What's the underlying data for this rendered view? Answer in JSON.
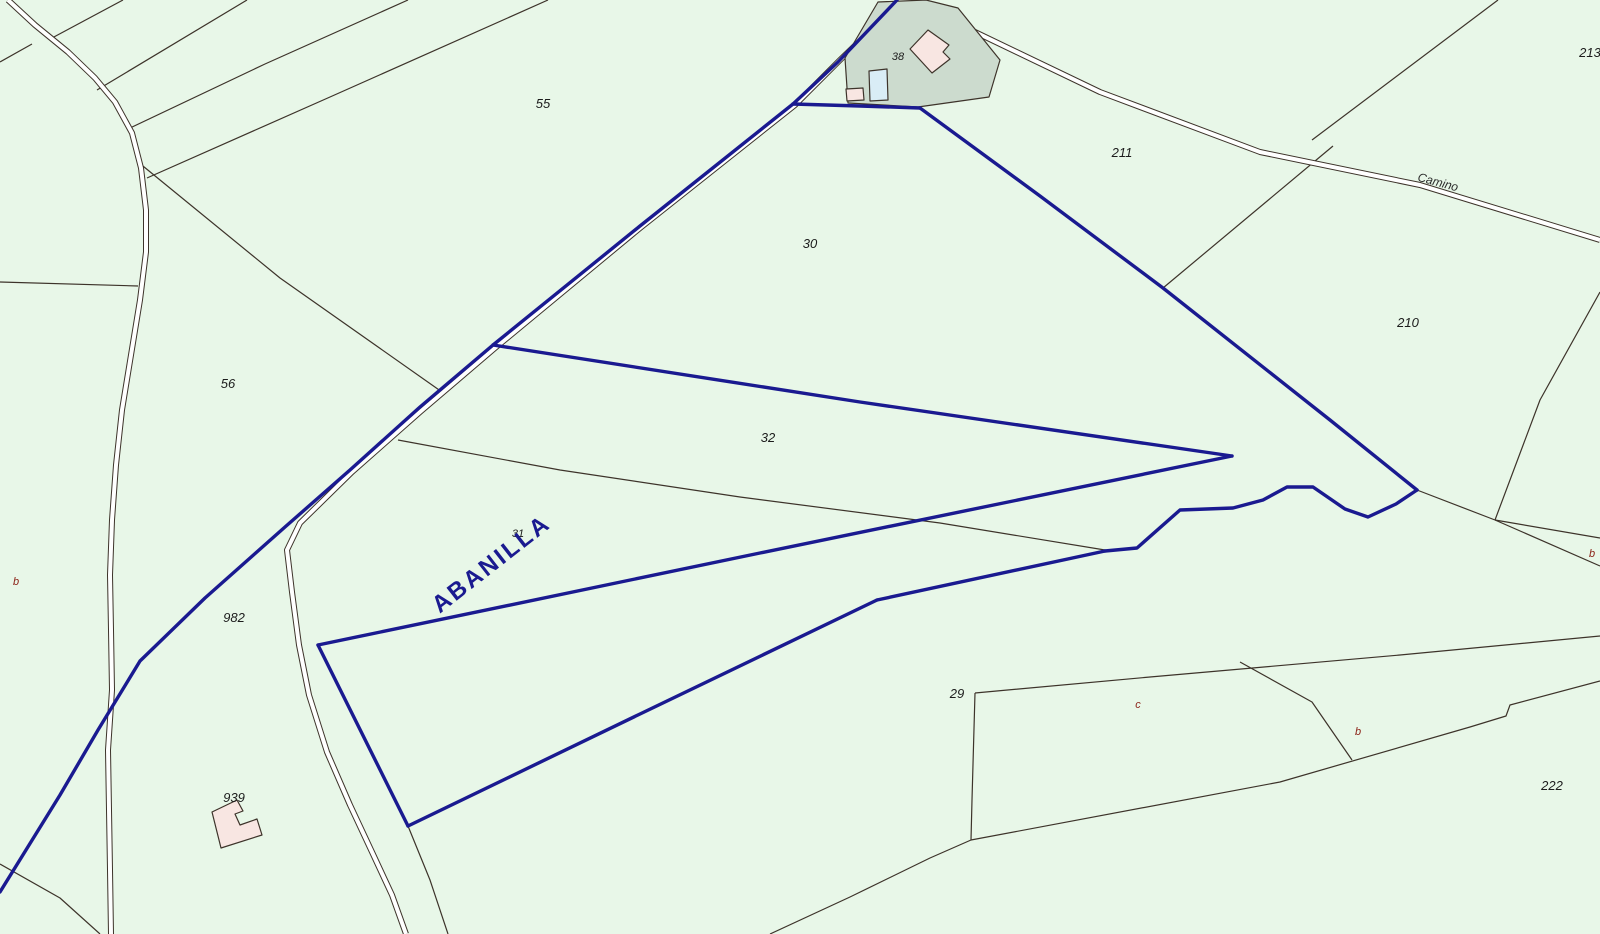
{
  "map": {
    "title": "cadastral-parcel-map",
    "colors": {
      "background": "#e8f7e8",
      "parcel_line": "#3d332a",
      "boundary": "#1a1a90",
      "road_fill": "#ffffff",
      "parcel38_fill": "#ccdbce",
      "building_fill": "#f8e6e2",
      "annex_blue_fill": "#d9edf6",
      "label": "#1c1c1c",
      "sub_label": "#8c2318"
    },
    "labels": [
      {
        "name": "parcel-55",
        "text": "55",
        "x": 543,
        "y": 108,
        "size": 13
      },
      {
        "name": "parcel-38",
        "text": "38",
        "x": 898,
        "y": 60,
        "size": 11
      },
      {
        "name": "parcel-211",
        "text": "211",
        "x": 1122,
        "y": 157,
        "size": 13
      },
      {
        "name": "parcel-213",
        "text": "213",
        "x": 1590,
        "y": 57,
        "size": 13
      },
      {
        "name": "road-camino",
        "text": "Camino",
        "x": 1437,
        "y": 186,
        "size": 12,
        "rotate": 15,
        "color": "#2b2b2b"
      },
      {
        "name": "parcel-30",
        "text": "30",
        "x": 810,
        "y": 248,
        "size": 13
      },
      {
        "name": "parcel-210",
        "text": "210",
        "x": 1408,
        "y": 327,
        "size": 13
      },
      {
        "name": "parcel-56",
        "text": "56",
        "x": 228,
        "y": 388,
        "size": 13
      },
      {
        "name": "parcel-32",
        "text": "32",
        "x": 768,
        "y": 442,
        "size": 13
      },
      {
        "name": "parcel-31",
        "text": "31",
        "x": 518,
        "y": 537,
        "size": 11
      },
      {
        "name": "municipality-abanilla",
        "text": "ABANILLA",
        "x": 496,
        "y": 570,
        "size": 24,
        "rotate": -38,
        "color": "#1a1a90",
        "bold": true,
        "spacing": 2.5
      },
      {
        "name": "sub-parcel-b-left",
        "text": "b",
        "x": 16,
        "y": 585,
        "size": 11,
        "color": "#8c2318"
      },
      {
        "name": "parcel-982",
        "text": "982",
        "x": 234,
        "y": 622,
        "size": 13
      },
      {
        "name": "sub-parcel-b-right",
        "text": "b",
        "x": 1592,
        "y": 557,
        "size": 11,
        "color": "#8c2318"
      },
      {
        "name": "parcel-939",
        "text": "939",
        "x": 234,
        "y": 802,
        "size": 13
      },
      {
        "name": "parcel-29",
        "text": "29",
        "x": 957,
        "y": 698,
        "size": 13
      },
      {
        "name": "sub-parcel-c",
        "text": "c",
        "x": 1138,
        "y": 708,
        "size": 11,
        "color": "#8c2318"
      },
      {
        "name": "sub-parcel-b-bottom",
        "text": "b",
        "x": 1358,
        "y": 735,
        "size": 11,
        "color": "#8c2318"
      },
      {
        "name": "parcel-222",
        "text": "222",
        "x": 1552,
        "y": 790,
        "size": 13
      }
    ],
    "roads": [
      {
        "name": "road-left-vertical",
        "points": [
          [
            8,
            0
          ],
          [
            35,
            25
          ],
          [
            68,
            52
          ],
          [
            95,
            78
          ],
          [
            115,
            102
          ],
          [
            132,
            133
          ],
          [
            141,
            168
          ],
          [
            146,
            210
          ],
          [
            146,
            252
          ],
          [
            140,
            300
          ],
          [
            131,
            355
          ],
          [
            122,
            410
          ],
          [
            116,
            465
          ],
          [
            112,
            520
          ],
          [
            110,
            575
          ],
          [
            111,
            630
          ],
          [
            112,
            690
          ],
          [
            108,
            750
          ],
          [
            109,
            810
          ],
          [
            110,
            870
          ],
          [
            111,
            934
          ]
        ]
      },
      {
        "name": "road-main-diagonal",
        "points": [
          [
            900,
            2
          ],
          [
            840,
            60
          ],
          [
            795,
            105
          ],
          [
            640,
            228
          ],
          [
            495,
            348
          ],
          [
            420,
            412
          ],
          [
            352,
            472
          ],
          [
            300,
            523
          ],
          [
            287,
            550
          ],
          [
            292,
            592
          ],
          [
            299,
            645
          ],
          [
            309,
            695
          ],
          [
            327,
            752
          ],
          [
            350,
            805
          ],
          [
            372,
            852
          ],
          [
            392,
            895
          ],
          [
            406,
            934
          ]
        ]
      },
      {
        "name": "road-camino",
        "points": [
          [
            950,
            20
          ],
          [
            1100,
            92
          ],
          [
            1260,
            152
          ],
          [
            1420,
            185
          ],
          [
            1600,
            240
          ]
        ]
      }
    ],
    "parcel_lines": [
      {
        "points": [
          [
            123,
            0
          ],
          [
            52,
            38
          ]
        ]
      },
      {
        "points": [
          [
            247,
            0
          ],
          [
            97,
            90
          ]
        ]
      },
      {
        "points": [
          [
            408,
            0
          ],
          [
            265,
            64
          ],
          [
            130,
            128
          ]
        ]
      },
      {
        "points": [
          [
            548,
            0
          ],
          [
            330,
            97
          ],
          [
            147,
            178
          ]
        ]
      },
      {
        "points": [
          [
            138,
            162
          ],
          [
            280,
            278
          ],
          [
            442,
            392
          ]
        ]
      },
      {
        "points": [
          [
            398,
            440
          ],
          [
            560,
            470
          ],
          [
            740,
            497
          ],
          [
            940,
            523
          ],
          [
            1105,
            550
          ]
        ]
      },
      {
        "points": [
          [
            1163,
            288
          ],
          [
            1333,
            146
          ]
        ]
      },
      {
        "points": [
          [
            1312,
            140
          ],
          [
            1498,
            0
          ]
        ]
      },
      {
        "points": [
          [
            1600,
            292
          ],
          [
            1540,
            400
          ],
          [
            1495,
            520
          ]
        ]
      },
      {
        "points": [
          [
            1495,
            520
          ],
          [
            1600,
            538
          ]
        ]
      },
      {
        "points": [
          [
            1495,
            520
          ],
          [
            1600,
            566
          ]
        ]
      },
      {
        "points": [
          [
            1417,
            490
          ],
          [
            1495,
            520
          ]
        ]
      },
      {
        "points": [
          [
            975,
            693
          ],
          [
            1150,
            677
          ],
          [
            1400,
            655
          ],
          [
            1600,
            636
          ]
        ]
      },
      {
        "points": [
          [
            975,
            693
          ],
          [
            972,
            800
          ],
          [
            971,
            840
          ]
        ]
      },
      {
        "points": [
          [
            770,
            934
          ],
          [
            850,
            897
          ],
          [
            930,
            858
          ],
          [
            971,
            840
          ],
          [
            1280,
            782
          ],
          [
            1470,
            727
          ],
          [
            1506,
            716
          ],
          [
            1510,
            705
          ],
          [
            1600,
            681
          ]
        ]
      },
      {
        "points": [
          [
            1240,
            662
          ],
          [
            1312,
            702
          ],
          [
            1352,
            760
          ]
        ]
      },
      {
        "points": [
          [
            0,
            282
          ],
          [
            138,
            286
          ]
        ]
      },
      {
        "points": [
          [
            0,
            62
          ],
          [
            32,
            44
          ]
        ]
      },
      {
        "points": [
          [
            0,
            864
          ],
          [
            60,
            898
          ],
          [
            100,
            934
          ]
        ]
      },
      {
        "points": [
          [
            408,
            826
          ],
          [
            430,
            880
          ],
          [
            448,
            934
          ]
        ]
      }
    ],
    "boundary_lines": [
      {
        "name": "boundary-nw-road",
        "points": [
          [
            897,
            0
          ],
          [
            838,
            62
          ],
          [
            793,
            104
          ],
          [
            640,
            226
          ],
          [
            493,
            345
          ],
          [
            420,
            407
          ],
          [
            350,
            470
          ],
          [
            285,
            527
          ],
          [
            205,
            598
          ],
          [
            140,
            661
          ],
          [
            98,
            730
          ],
          [
            60,
            795
          ],
          [
            0,
            892
          ]
        ]
      },
      {
        "name": "boundary-top-under-building",
        "points": [
          [
            793,
            104
          ],
          [
            860,
            106
          ],
          [
            920,
            108
          ]
        ]
      },
      {
        "name": "boundary-ne-diagonal",
        "points": [
          [
            920,
            108
          ],
          [
            1040,
            196
          ],
          [
            1163,
            288
          ],
          [
            1330,
            420
          ],
          [
            1417,
            490
          ]
        ]
      },
      {
        "name": "boundary-east-wavy",
        "points": [
          [
            1417,
            490
          ],
          [
            1396,
            504
          ],
          [
            1368,
            517
          ],
          [
            1345,
            509
          ],
          [
            1313,
            487
          ],
          [
            1287,
            487
          ],
          [
            1263,
            500
          ],
          [
            1233,
            508
          ],
          [
            1180,
            510
          ],
          [
            1137,
            548
          ],
          [
            1105,
            551
          ]
        ]
      },
      {
        "name": "boundary-south-upper",
        "points": [
          [
            1105,
            551
          ],
          [
            877,
            600
          ]
        ]
      },
      {
        "name": "boundary-south-long",
        "points": [
          [
            877,
            600
          ],
          [
            640,
            714
          ],
          [
            408,
            826
          ]
        ]
      },
      {
        "name": "boundary-west-short",
        "points": [
          [
            408,
            826
          ],
          [
            318,
            645
          ]
        ]
      },
      {
        "name": "boundary-abanilla-edge",
        "points": [
          [
            318,
            645
          ],
          [
            760,
            553
          ],
          [
            1232,
            456
          ]
        ]
      },
      {
        "name": "boundary-middle-edge",
        "points": [
          [
            493,
            345
          ],
          [
            860,
            402
          ],
          [
            1232,
            456
          ]
        ]
      }
    ],
    "shapes": [
      {
        "name": "parcel-38-area",
        "fill": "parcel38_fill",
        "points": [
          [
            878,
            2
          ],
          [
            926,
            0
          ],
          [
            958,
            8
          ],
          [
            1000,
            60
          ],
          [
            989,
            97
          ],
          [
            918,
            107
          ],
          [
            848,
            103
          ],
          [
            845,
            58
          ]
        ]
      },
      {
        "name": "building-38",
        "fill": "building_fill",
        "points": [
          [
            928,
            30
          ],
          [
            949,
            45
          ],
          [
            943,
            52
          ],
          [
            950,
            59
          ],
          [
            932,
            73
          ],
          [
            910,
            49
          ]
        ]
      },
      {
        "name": "building-38-annex-blue",
        "fill": "annex_blue_fill",
        "points": [
          [
            869,
            71
          ],
          [
            887,
            69
          ],
          [
            888,
            100
          ],
          [
            870,
            101
          ]
        ]
      },
      {
        "name": "building-38-annex-pink",
        "fill": "building_fill",
        "points": [
          [
            846,
            89
          ],
          [
            863,
            88
          ],
          [
            864,
            100
          ],
          [
            847,
            101
          ]
        ]
      },
      {
        "name": "building-939",
        "fill": "building_fill",
        "points": [
          [
            212,
            812
          ],
          [
            237,
            800
          ],
          [
            243,
            811
          ],
          [
            235,
            814
          ],
          [
            240,
            825
          ],
          [
            257,
            819
          ],
          [
            262,
            835
          ],
          [
            221,
            848
          ]
        ]
      }
    ]
  }
}
